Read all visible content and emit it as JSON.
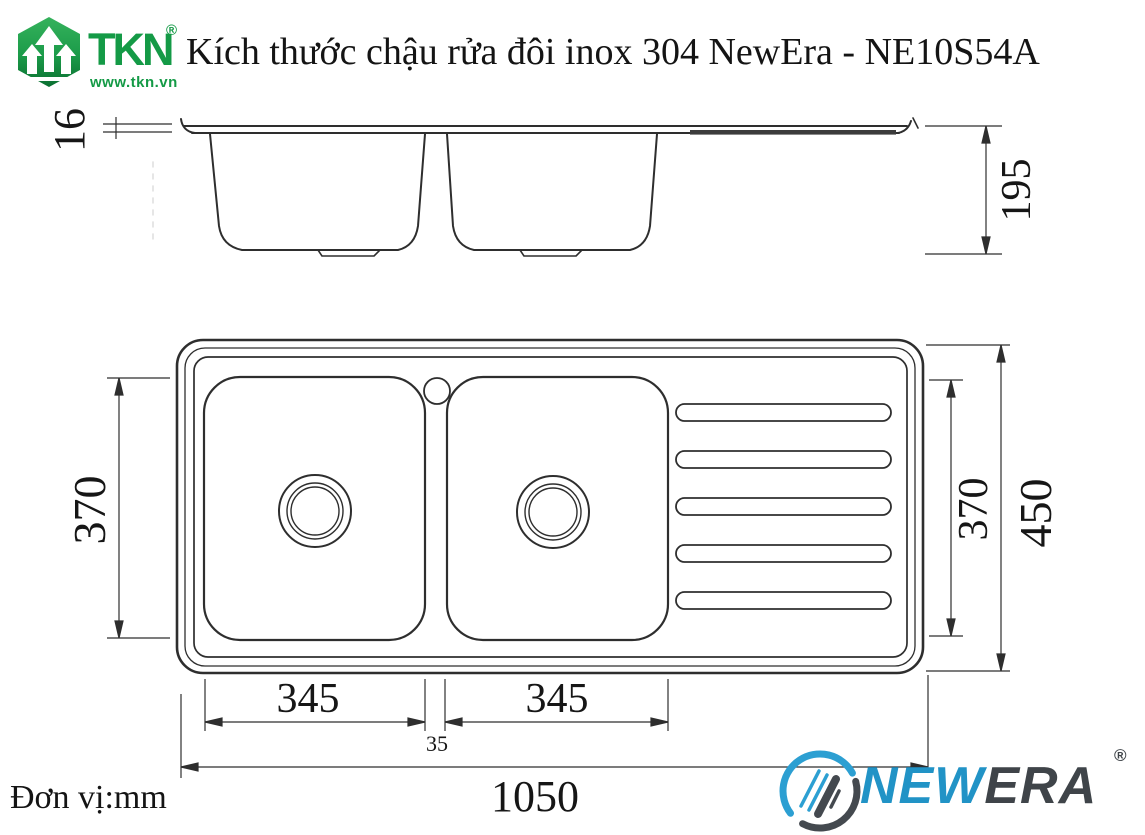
{
  "header": {
    "tkn": {
      "name": "TKN",
      "reg": "®",
      "website": "www.tkn.vn"
    },
    "title": "Kích thước chậu rửa đôi inox 304 NewEra - NE10S54A"
  },
  "dims": {
    "rim_thickness": "16",
    "depth": "195",
    "left_370": "370",
    "right_370": "370",
    "overall_450": "450",
    "bowl_345_left": "345",
    "bowl_345_right": "345",
    "divider_35": "35",
    "overall_1050": "1050"
  },
  "note": {
    "unit": "Đơn vị:mm"
  },
  "newera": {
    "new": "NEW",
    "era": "ERA",
    "reg": "®"
  },
  "colors": {
    "tkn_green": "#149a46",
    "newera_blue": "#2193c6",
    "newera_dark": "#3f4449",
    "line": "#2e2e2e"
  }
}
